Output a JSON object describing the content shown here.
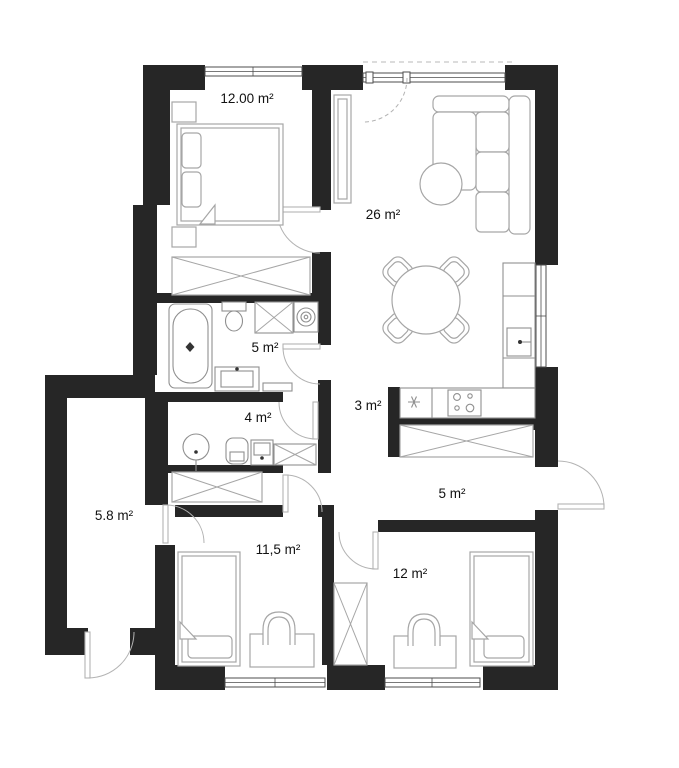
{
  "page": {
    "title": "Apartment floor plan"
  },
  "rooms": [
    {
      "id": "bedroom-main",
      "area_label": "12.00 m²"
    },
    {
      "id": "living-room",
      "area_label": "26 m²"
    },
    {
      "id": "bathroom",
      "area_label": "5 m²"
    },
    {
      "id": "wc",
      "area_label": "4 m²"
    },
    {
      "id": "kitchen-passage",
      "area_label": "3 m²"
    },
    {
      "id": "hallway",
      "area_label": "5 m²"
    },
    {
      "id": "entry-hall",
      "area_label": "5.8 m²"
    },
    {
      "id": "bedroom-left",
      "area_label": "11,5 m²"
    },
    {
      "id": "bedroom-right",
      "area_label": "12 m²"
    }
  ],
  "colors": {
    "wall": "#262626",
    "furniture": "#a6a6a6",
    "fixture": "#8f8f8f",
    "door": "#b3b3b3",
    "window_frame": "#4d4d4d",
    "background": "#ffffff",
    "label": "#111111"
  }
}
